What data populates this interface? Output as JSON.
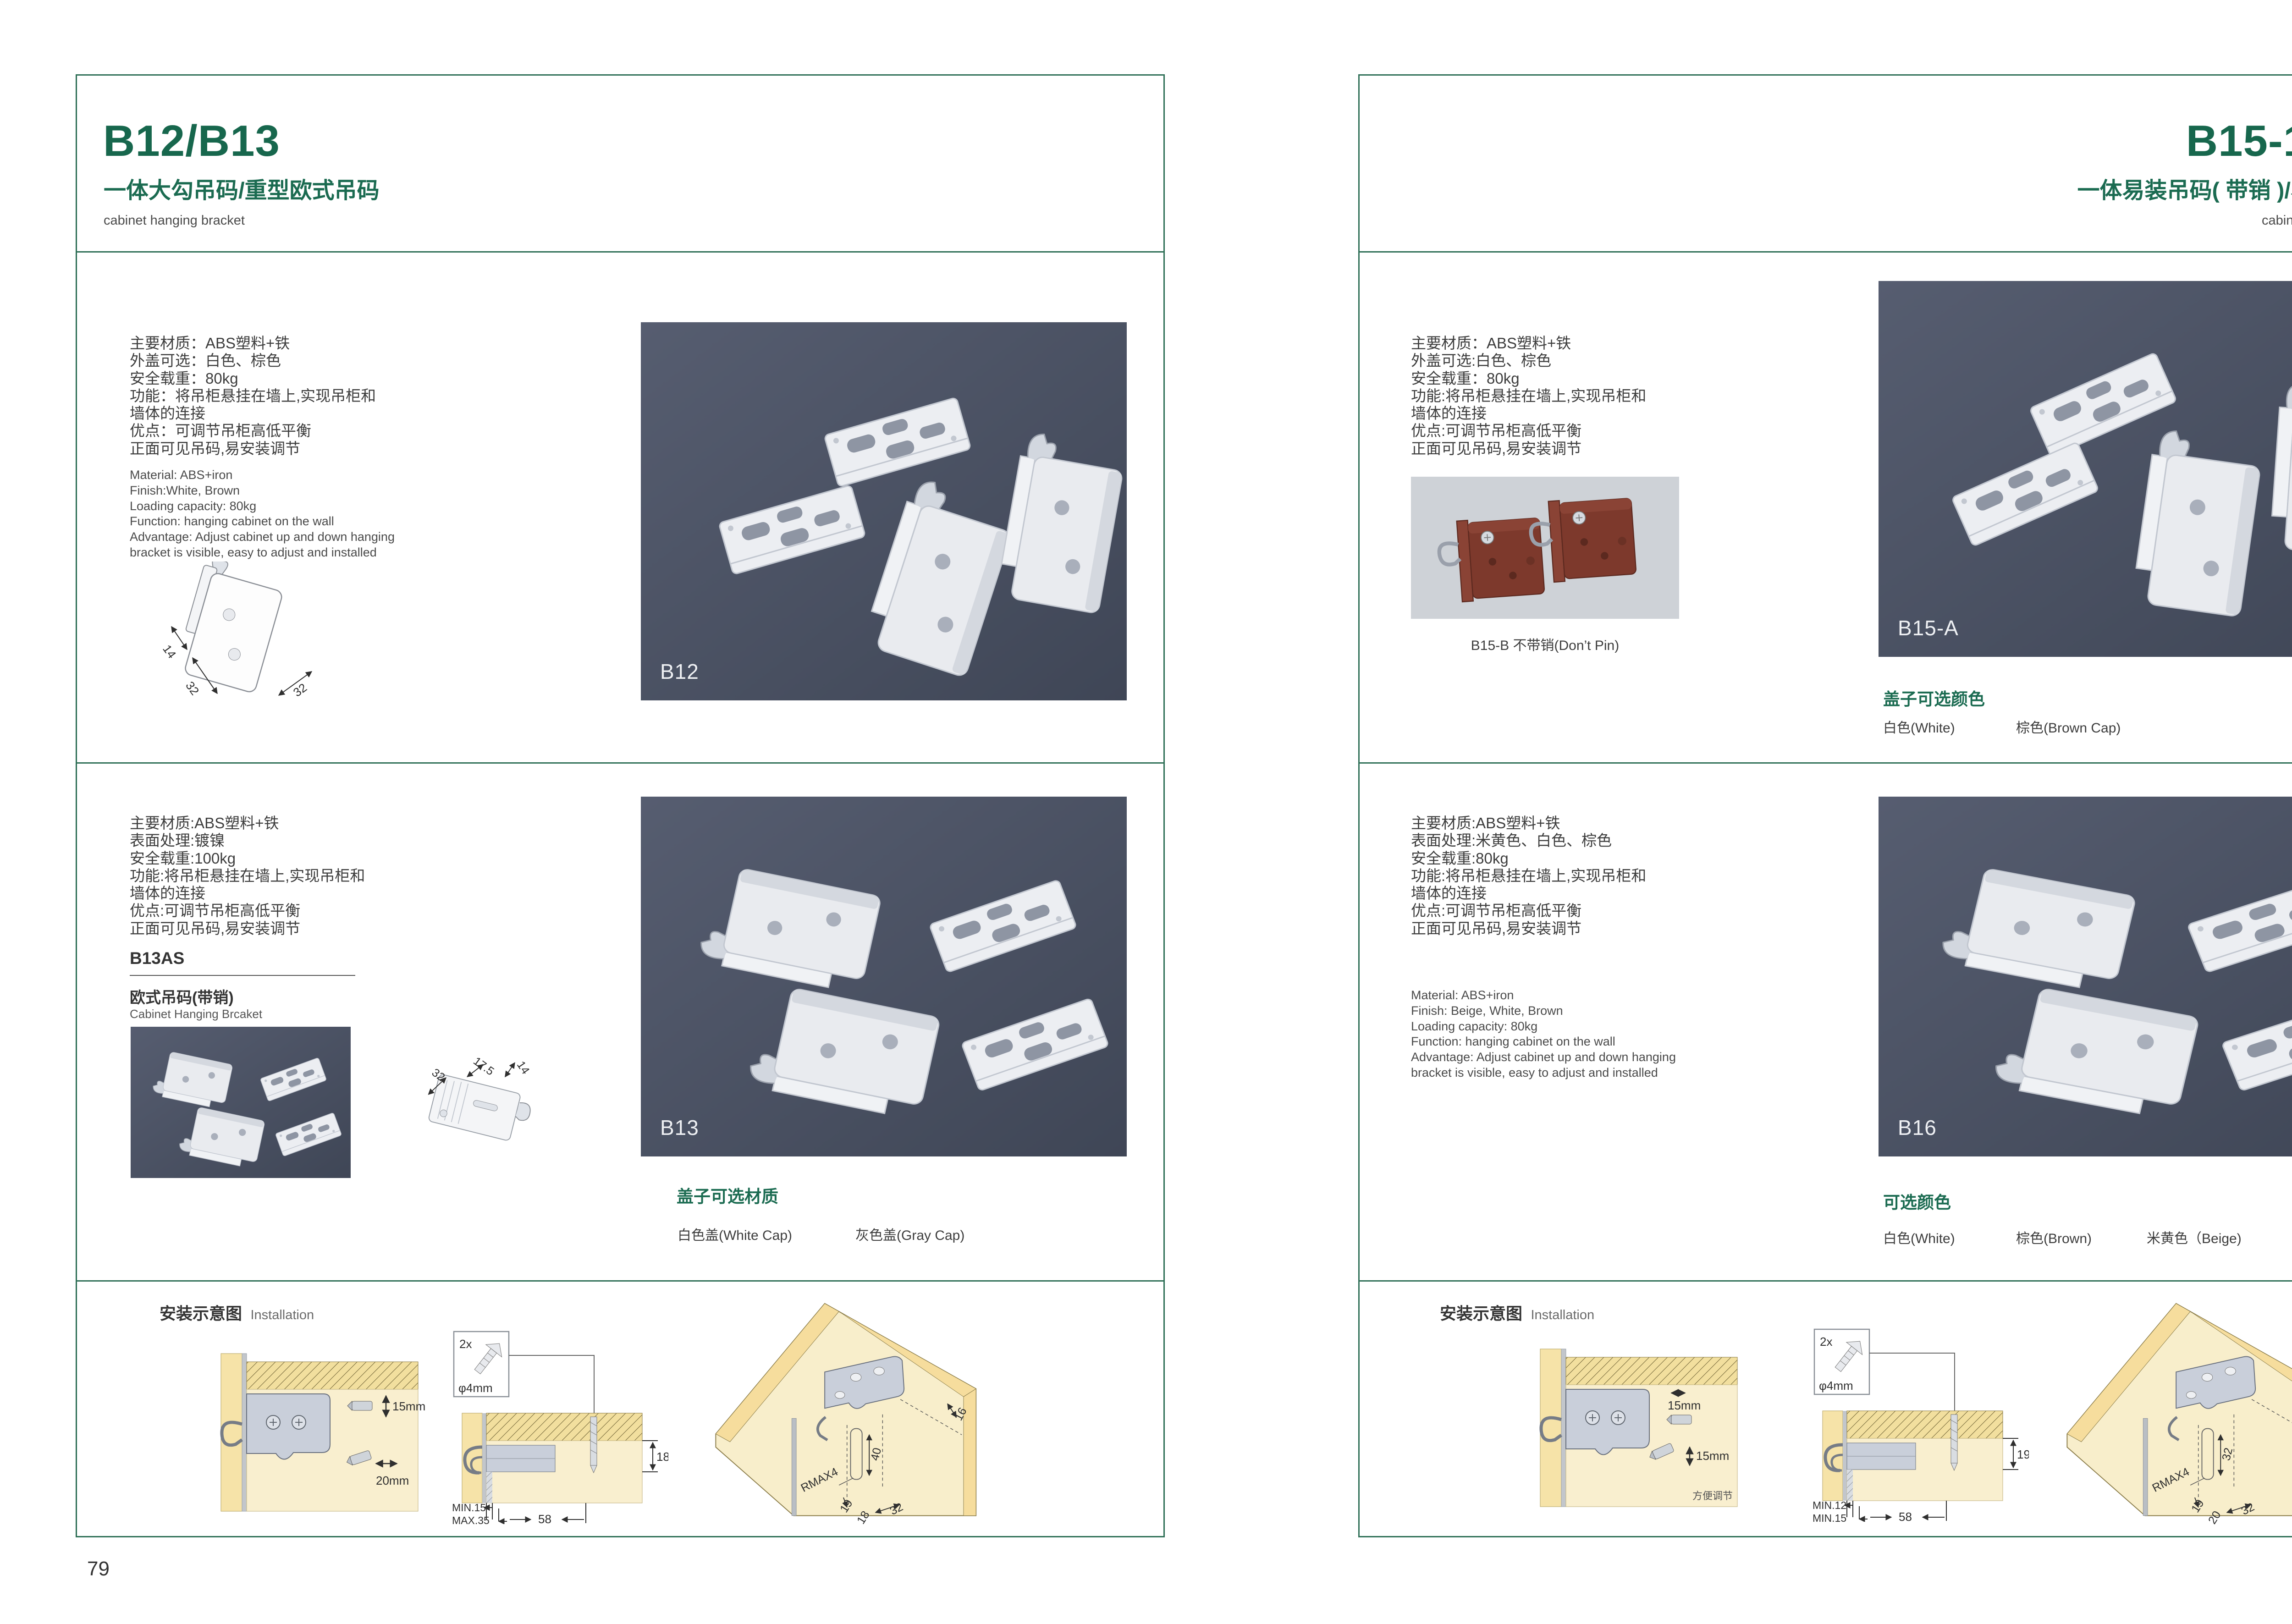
{
  "colors": {
    "accent_green": "#1b6b51",
    "photo_background": "#4b5263",
    "wood_cream": "#f8eecb",
    "wood_yellow": "#f6dd9d"
  },
  "page_left": {
    "page_number": "79",
    "header": {
      "title": "B12/B13",
      "subtitle_zh": "一体大勾吊码/重型欧式吊码",
      "subtitle_en": "cabinet hanging bracket"
    },
    "section1": {
      "specs_zh": [
        "主要材质：ABS塑料+铁",
        "外盖可选：白色、棕色",
        "安全载重：80kg",
        "功能：将吊柜悬挂在墙上,实现吊柜和",
        "墙体的连接",
        "优点：可调节吊柜高低平衡",
        "正面可见吊码,易安装调节"
      ],
      "specs_en": [
        "Material: ABS+iron",
        "Finish:White, Brown",
        "Loading capacity: 80kg",
        "Function: hanging cabinet on the wall",
        "Advantage: Adjust cabinet up and down hanging",
        "bracket is visible, easy to adjust and installed"
      ],
      "drawing_dims": {
        "d1": "14",
        "d2": "32",
        "d3": "32"
      },
      "photo_label": "B12"
    },
    "section2": {
      "specs_zh": [
        "主要材质:ABS塑料+铁",
        "表面处理:镀镍",
        "安全载重:100kg",
        "功能:将吊柜悬挂在墙上,实现吊柜和",
        "墙体的连接",
        "优点:可调节吊柜高低平衡",
        "正面可见吊码,易安装调节"
      ],
      "model_code": "B13AS",
      "model_name_zh": "欧式吊码(带销)",
      "model_name_en": "Cabinet Hanging Brcaket",
      "drawing_dims": {
        "d1": "32",
        "d2": "17.5",
        "d3": "14"
      },
      "photo_label": "B13",
      "options_heading": "盖子可选材质",
      "options": [
        "白色盖(White Cap)",
        "灰色盖(Gray Cap)"
      ]
    },
    "installation": {
      "heading_zh": "安装示意图",
      "heading_en": "Installation",
      "diag1": {
        "dim1": "15mm",
        "dim2": "20mm"
      },
      "diag2": {
        "screw_count": "2x",
        "screw_dia": "φ4mm",
        "side_dim": "18",
        "min_label": "MIN.15",
        "max_label": "MAX.35",
        "width_dim": "58"
      },
      "diag3": {
        "edge": "16",
        "depth": "40",
        "radius": "RMAX4",
        "d19": "19",
        "d18": "18",
        "d32": "32"
      }
    }
  },
  "page_right": {
    "page_number": "80",
    "header": {
      "title": "B15-1/B16",
      "subtitle_zh": "一体易装吊码( 带销 )/易调节吊码",
      "subtitle_en": "cabinet hanging bracket"
    },
    "section1": {
      "specs_zh": [
        "主要材质：ABS塑料+铁",
        "外盖可选:白色、棕色",
        "安全载重：80kg",
        "功能:将吊柜悬挂在墙上,实现吊柜和",
        "墙体的连接",
        "优点:可调节吊柜高低平衡",
        "正面可见吊码,易安装调节"
      ],
      "sub_photo_caption": "B15-B 不带销(Don’t Pin)",
      "photo_label": "B15-A",
      "options_heading": "盖子可选颜色",
      "options": [
        "白色(White)",
        "棕色(Brown Cap)"
      ]
    },
    "section2": {
      "specs_zh": [
        "主要材质:ABS塑料+铁",
        "表面处理:米黄色、白色、棕色",
        "安全载重:80kg",
        "功能:将吊柜悬挂在墙上,实现吊柜和",
        "墙体的连接",
        "优点:可调节吊柜高低平衡",
        "正面可见吊码,易安装调节"
      ],
      "specs_en": [
        "Material: ABS+iron",
        "Finish: Beige, White, Brown",
        "Loading capacity: 80kg",
        "Function: hanging cabinet on the wall",
        "Advantage: Adjust cabinet up and down hanging",
        "bracket is visible, easy to adjust and installed"
      ],
      "photo_label": "B16",
      "options_heading": "可选颜色",
      "options": [
        "白色(White)",
        "棕色(Brown)",
        "米黄色（Beige)"
      ]
    },
    "installation": {
      "heading_zh": "安装示意图",
      "heading_en": "Installation",
      "diag1": {
        "dim1": "15mm",
        "dim2": "15mm",
        "note": "方便调节"
      },
      "diag2": {
        "screw_count": "2x",
        "screw_dia": "φ4mm",
        "side_dim": "19",
        "min_label": "MIN.12",
        "max_label": "MIN.15",
        "width_dim": "58"
      },
      "diag3": {
        "edge": "30",
        "depth": "32",
        "radius": "RMAX4",
        "d19": "19",
        "d18": "20",
        "d32": "32"
      }
    }
  }
}
